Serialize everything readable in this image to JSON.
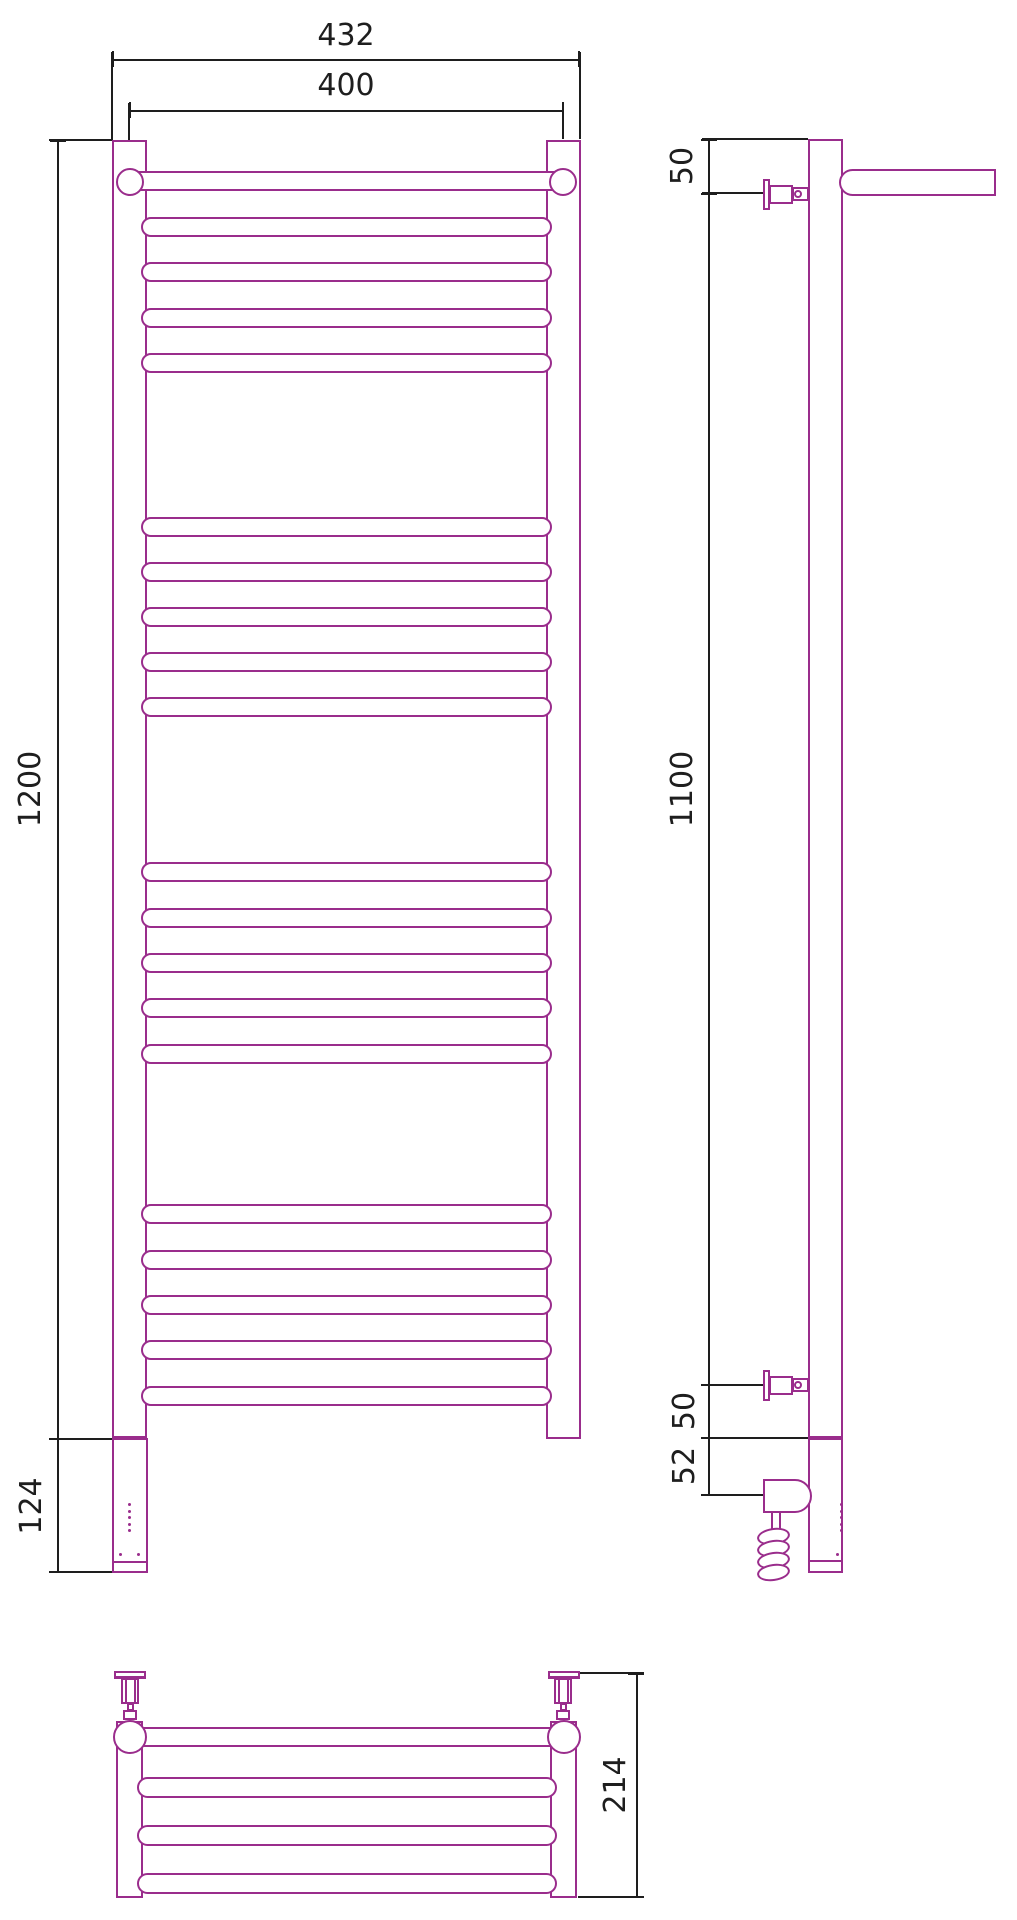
{
  "title": "Heated towel rail with shelf — dimensional drawing (front, side and top views)",
  "colors": {
    "outline": "#9A2D8C",
    "dimension": "#1E1E1E",
    "background": "#FFFFFF"
  },
  "dims": {
    "overall_width": "432",
    "rail_spacing": "400",
    "overall_height": "1200",
    "housing_height": "124",
    "top_bracket_offset": "50",
    "bracket_span": "1100",
    "bottom_bracket_offset": "50",
    "heater_axis_offset": "52",
    "shelf_depth": "214"
  },
  "front_view": {
    "rung_tops": [
      217,
      262,
      308,
      353,
      517,
      562,
      607,
      652,
      697,
      862,
      908,
      953,
      998,
      1044,
      1204,
      1250,
      1295,
      1340,
      1386
    ],
    "led_dot_tops": [
      1503,
      1509.5,
      1516,
      1522.5,
      1529
    ],
    "screw_dot_positions": [
      [
        118.5,
        1553
      ],
      [
        136.5,
        1553
      ]
    ]
  },
  "side_view": {
    "led_dot_tops": [
      1503,
      1509.5,
      1516,
      1522.5,
      1529
    ],
    "coil_loop_tops": [
      1528,
      1540,
      1552,
      1564
    ],
    "bottom_dot": [
      836,
      1553
    ]
  },
  "top_view": {
    "shelf_bar_tops": [
      1777,
      1825,
      1873
    ]
  }
}
